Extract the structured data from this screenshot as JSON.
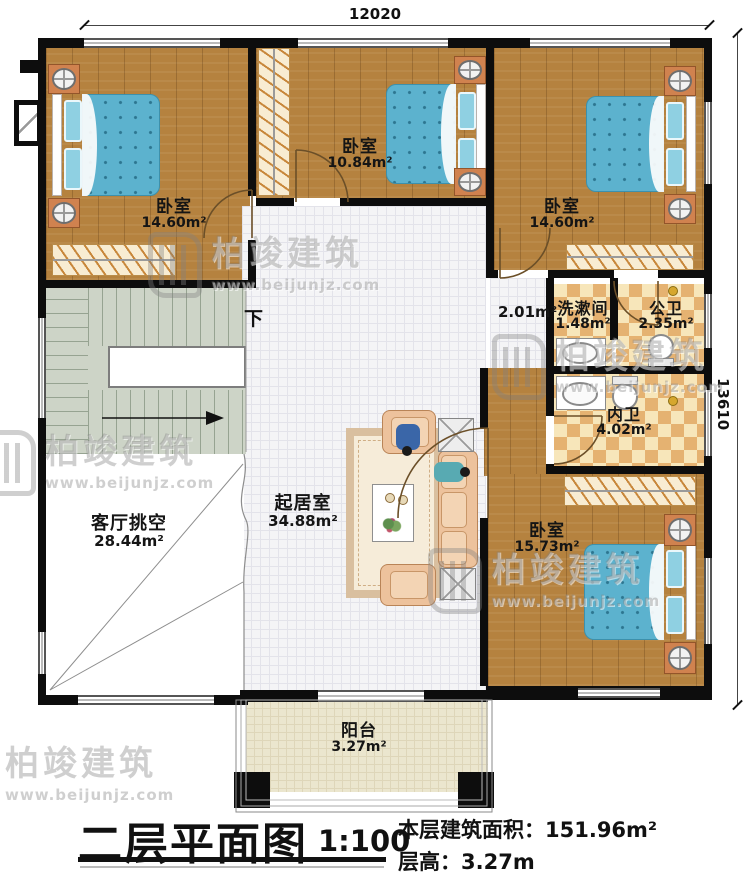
{
  "dimensions": {
    "top": "12020",
    "right": "13610"
  },
  "rooms": {
    "bedroom_tl": {
      "name": "卧室",
      "area": "14.60m²"
    },
    "bedroom_tm": {
      "name": "卧室",
      "area": "10.84m²"
    },
    "bedroom_tr": {
      "name": "卧室",
      "area": "14.60m²"
    },
    "hall": {
      "area": "2.01m²"
    },
    "washroom": {
      "name": "洗漱间",
      "area": "1.48m²"
    },
    "public_bath": {
      "name": "公卫",
      "area": "2.35m²"
    },
    "ensuite_bath": {
      "name": "内卫",
      "area": "4.02m²"
    },
    "bedroom_br": {
      "name": "卧室",
      "area": "15.73m²"
    },
    "living": {
      "name": "起居室",
      "area": "34.88m²"
    },
    "void": {
      "name": "客厅挑空",
      "area": "28.44m²"
    },
    "balcony": {
      "name": "阳台",
      "area": "3.27m²"
    }
  },
  "stairs": {
    "down": "下"
  },
  "watermark": {
    "brand": "柏竣建筑",
    "site": "www.beijunjz.com"
  },
  "title_block": {
    "title": "二层平面图",
    "scale": "1:100",
    "area_label": "本层建筑面积：",
    "area_value": "151.96m²",
    "floor_height_label": "层高：",
    "floor_height_value": "3.27m"
  },
  "colors": {
    "wall": "#0d0d0d",
    "wood_floor": "#b5823f",
    "tile_floor": "#f4f4f6",
    "bath_checker_dark": "#e5b271",
    "bath_checker_light": "#f7e6ba",
    "stairs": "#cdd4c7",
    "balcony_floor": "#ebe6ce",
    "bed": "#5cb2ce",
    "nightstand": "#d0824f"
  }
}
